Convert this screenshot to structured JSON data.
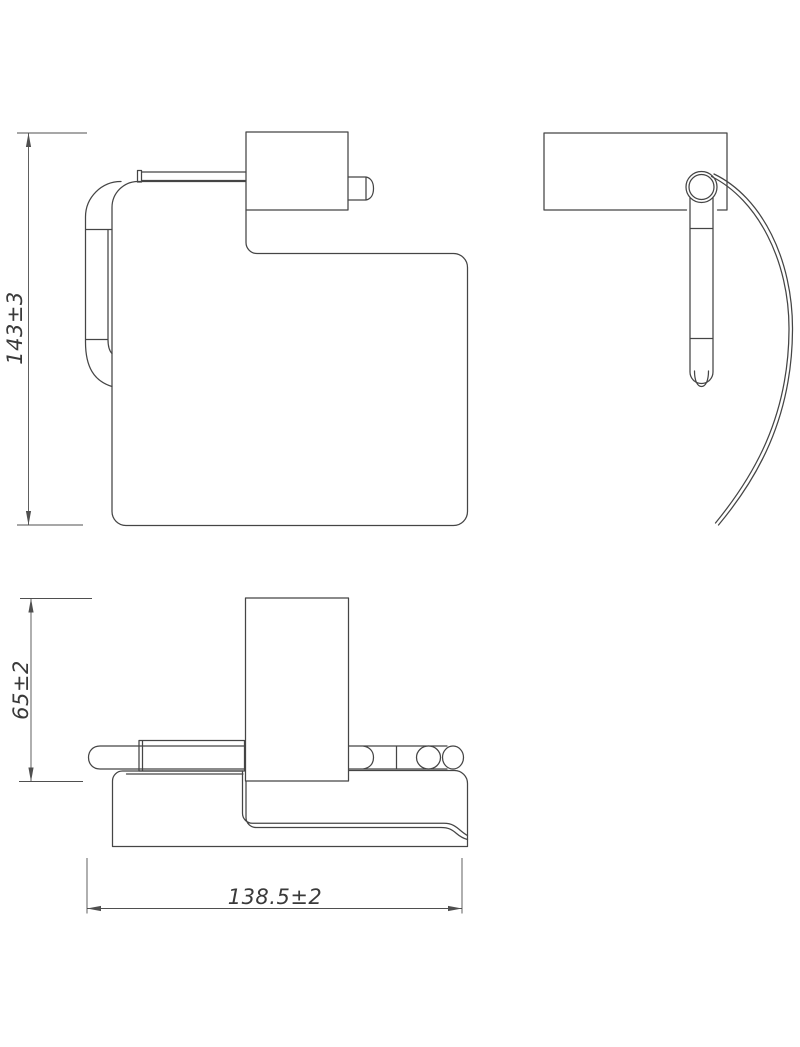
{
  "drawing": {
    "type": "technical-dimension-drawing",
    "subject": "wall-mounted toilet paper holder with cover, three orthographic views",
    "background_color": "#ffffff",
    "line_color": "#454545",
    "dim_line_color": "#4f4f4f",
    "text_color": "#3a3a3a",
    "views": {
      "front": "front view (cover, wall bracket, roll arm)",
      "side": "side view (wall plate, pivot, hanging arm, paper sheet curve)",
      "bottom": "bottom view (bracket, spindle bar, cover)"
    },
    "dimensions": {
      "height": "143±3",
      "depth": "65±2",
      "width": "138.5±2"
    }
  }
}
